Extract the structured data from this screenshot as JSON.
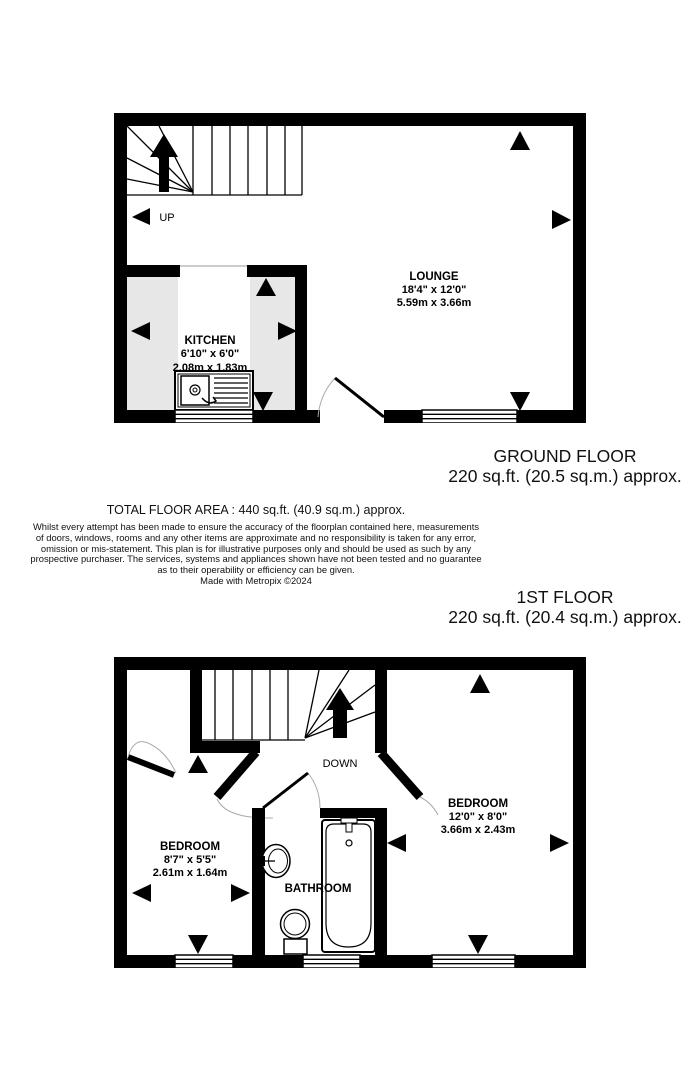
{
  "ground_floor": {
    "label": "GROUND FLOOR",
    "area": "220 sq.ft. (20.5 sq.m.) approx.",
    "stairs_label": "UP",
    "rooms": {
      "lounge": {
        "name": "LOUNGE",
        "imperial": "18'4\" x 12'0\"",
        "metric": "5.59m x 3.66m"
      },
      "kitchen": {
        "name": "KITCHEN",
        "imperial": "6'10\" x 6'0\"",
        "metric": "2.08m x 1.83m"
      }
    }
  },
  "first_floor": {
    "label": "1ST FLOOR",
    "area": "220 sq.ft. (20.4 sq.m.) approx.",
    "stairs_label": "DOWN",
    "rooms": {
      "bedroom_left": {
        "name": "BEDROOM",
        "imperial": "8'7\" x 5'5\"",
        "metric": "2.61m x 1.64m"
      },
      "bedroom_right": {
        "name": "BEDROOM",
        "imperial": "12'0\" x 8'0\"",
        "metric": "3.66m x 2.43m"
      },
      "bathroom": {
        "name": "BATHROOM"
      }
    }
  },
  "summary": {
    "total_area": "TOTAL FLOOR AREA : 440 sq.ft. (40.9 sq.m.) approx.",
    "disclaimer_lines": [
      "Whilst every attempt has been made to ensure the accuracy of the floorplan contained here, measurements",
      "of doors, windows, rooms and any other items are approximate and no responsibility is taken for any error,",
      "omission or mis-statement. This plan is for illustrative purposes only and should be used as such by any",
      "prospective purchaser. The services, systems and appliances shown have not been tested and no guarantee",
      "as to their operability or efficiency can be given."
    ],
    "credit": "Made with Metropix ©2024"
  },
  "colors": {
    "wall": "#000000",
    "kitchen_fill": "#e7e7e7",
    "text": "#111111"
  }
}
